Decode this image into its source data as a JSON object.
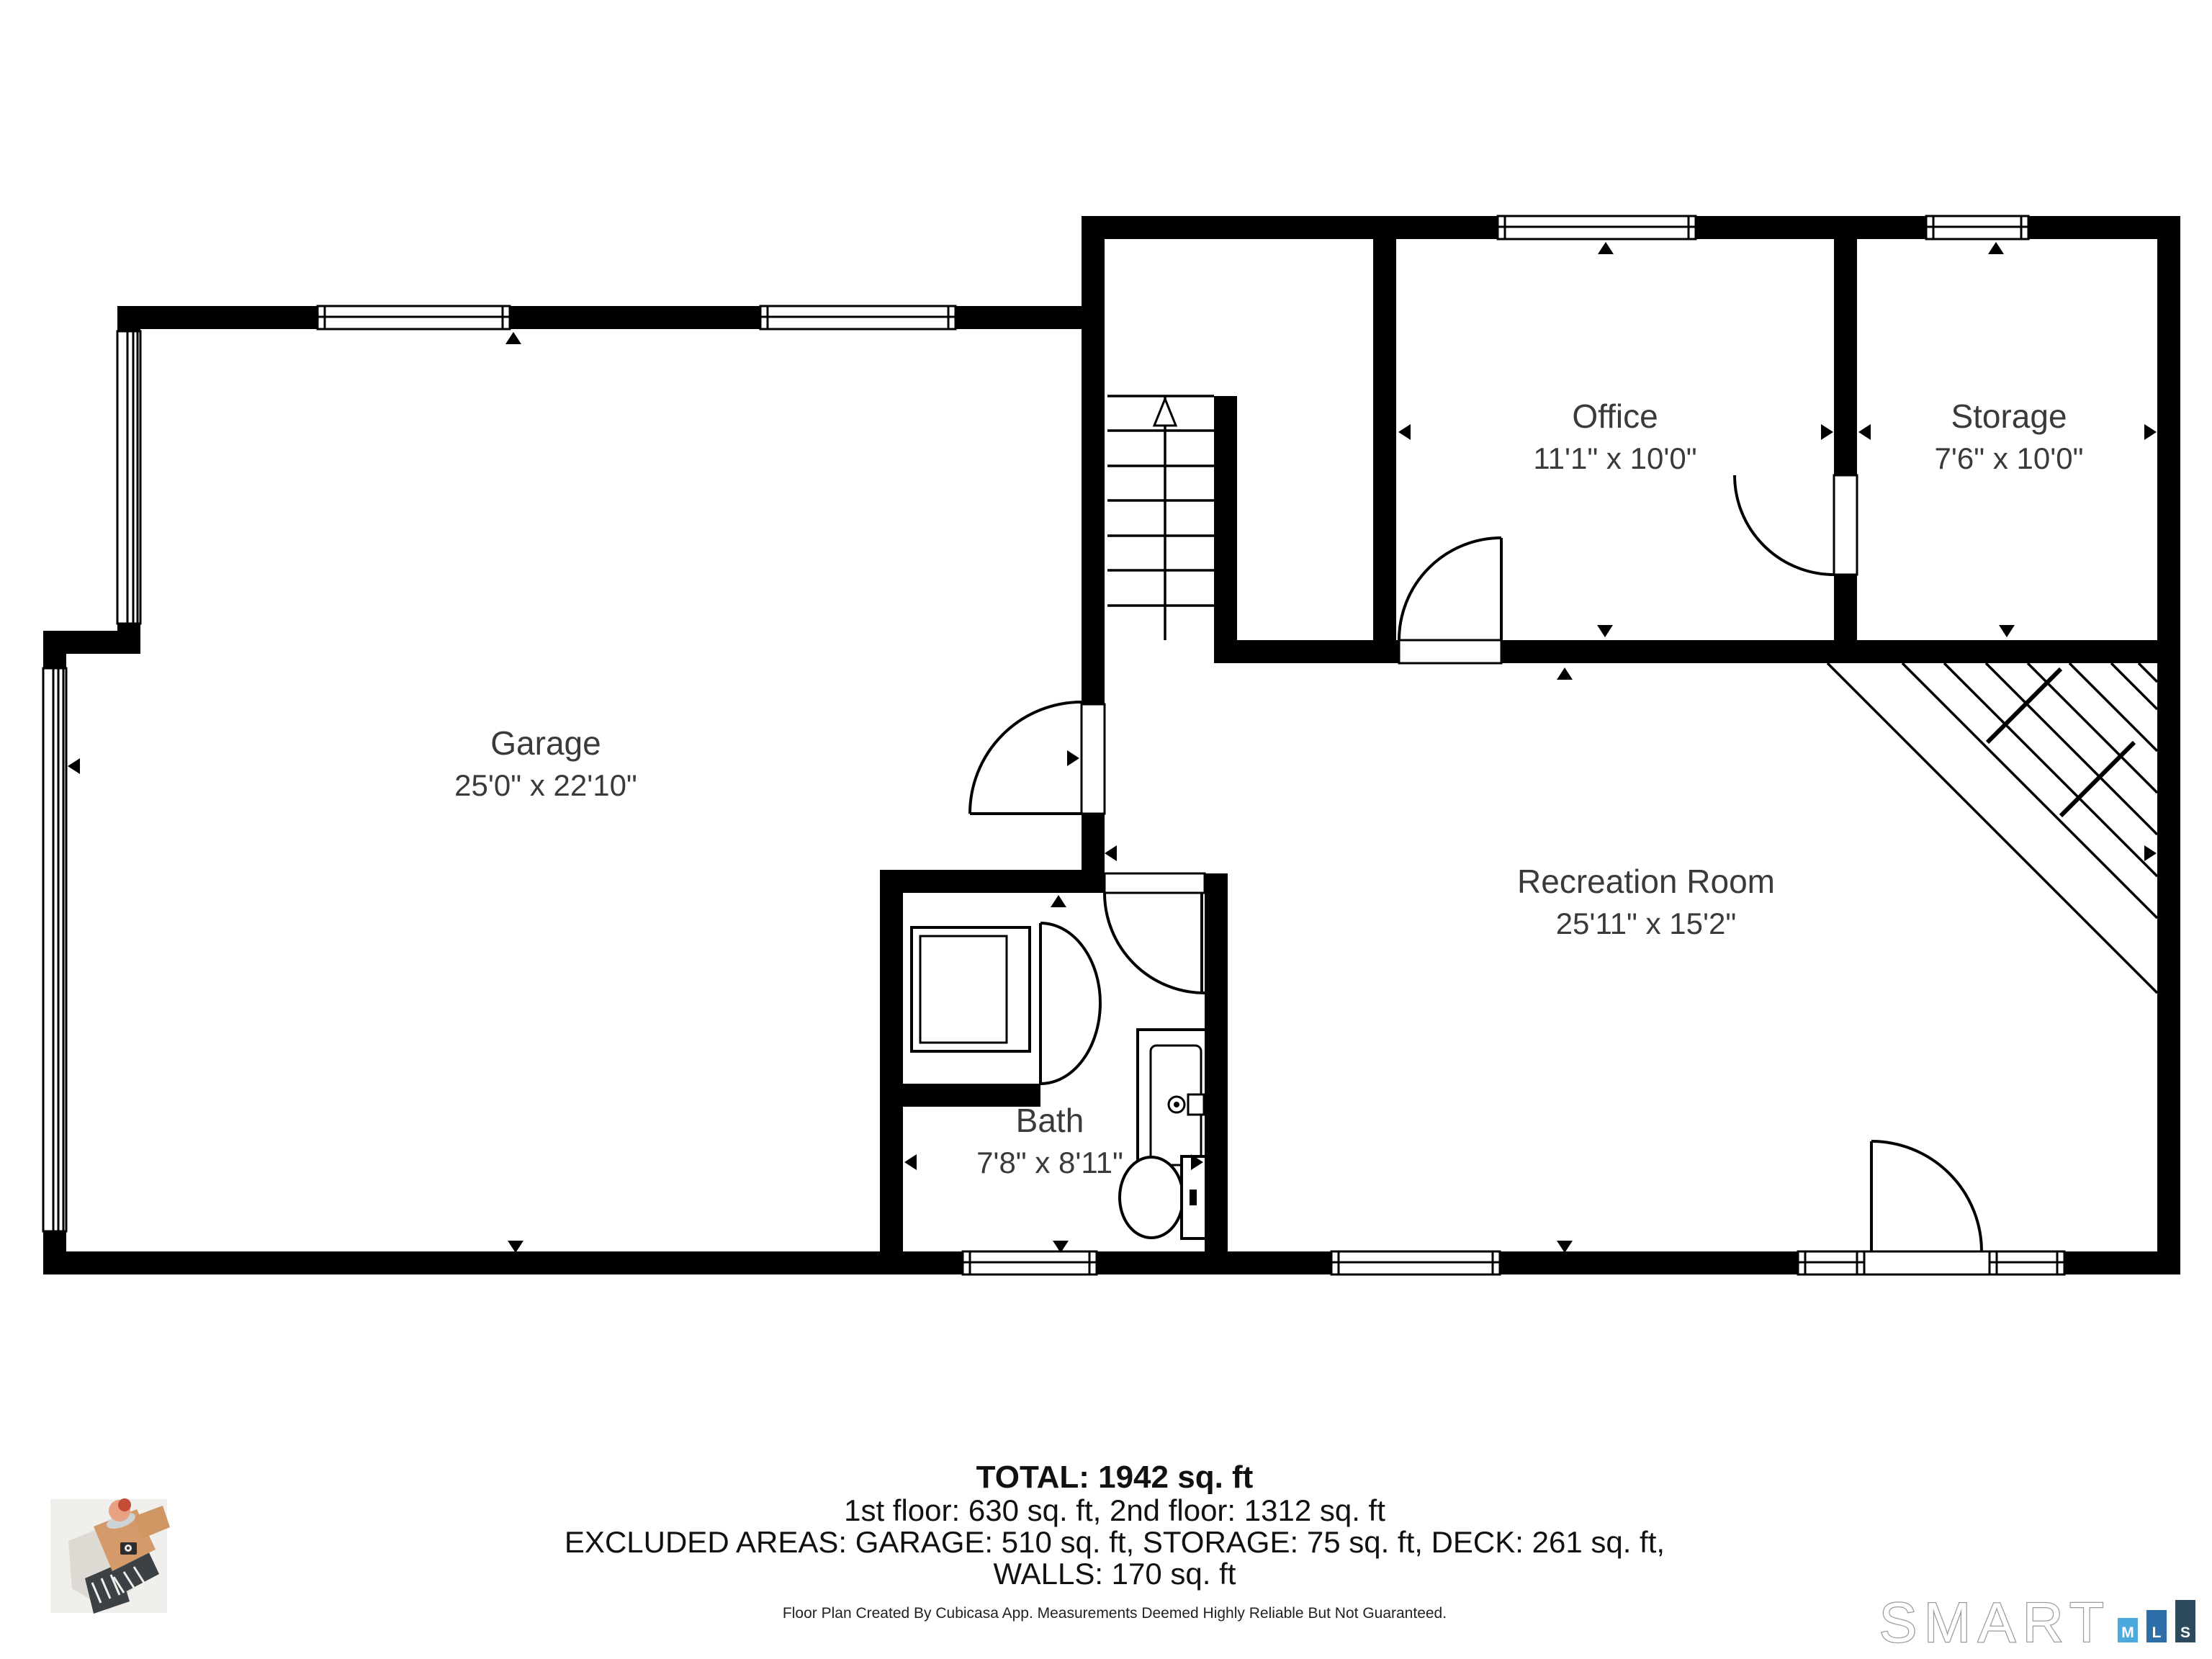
{
  "plan": {
    "rooms": [
      {
        "name": "Garage",
        "dims": "25'0\" x 22'10\""
      },
      {
        "name": "Office",
        "dims": "11'1\" x 10'0\""
      },
      {
        "name": "Storage",
        "dims": "7'6\" x 10'0\""
      },
      {
        "name": "Recreation Room",
        "dims": "25'11\" x 15'2\""
      },
      {
        "name": "Bath",
        "dims": "7'8\" x 8'11\""
      }
    ]
  },
  "summary": {
    "total": "TOTAL: 1942 sq. ft",
    "floors": "1st floor: 630 sq. ft, 2nd floor: 1312 sq. ft",
    "excluded": "EXCLUDED AREAS: GARAGE: 510 sq. ft, STORAGE: 75 sq. ft, DECK: 261 sq. ft,",
    "walls": "WALLS: 170 sq. ft"
  },
  "footer": {
    "disclaimer": "Floor Plan Created By Cubicasa App. Measurements Deemed Highly Reliable But Not Guaranteed."
  },
  "branding": {
    "smart_text": "SMART",
    "mls_letters": [
      "M",
      "L",
      "S"
    ],
    "colors": {
      "m": "#4BA9DE",
      "l": "#2D6DA8",
      "s": "#2B4A5E"
    }
  }
}
